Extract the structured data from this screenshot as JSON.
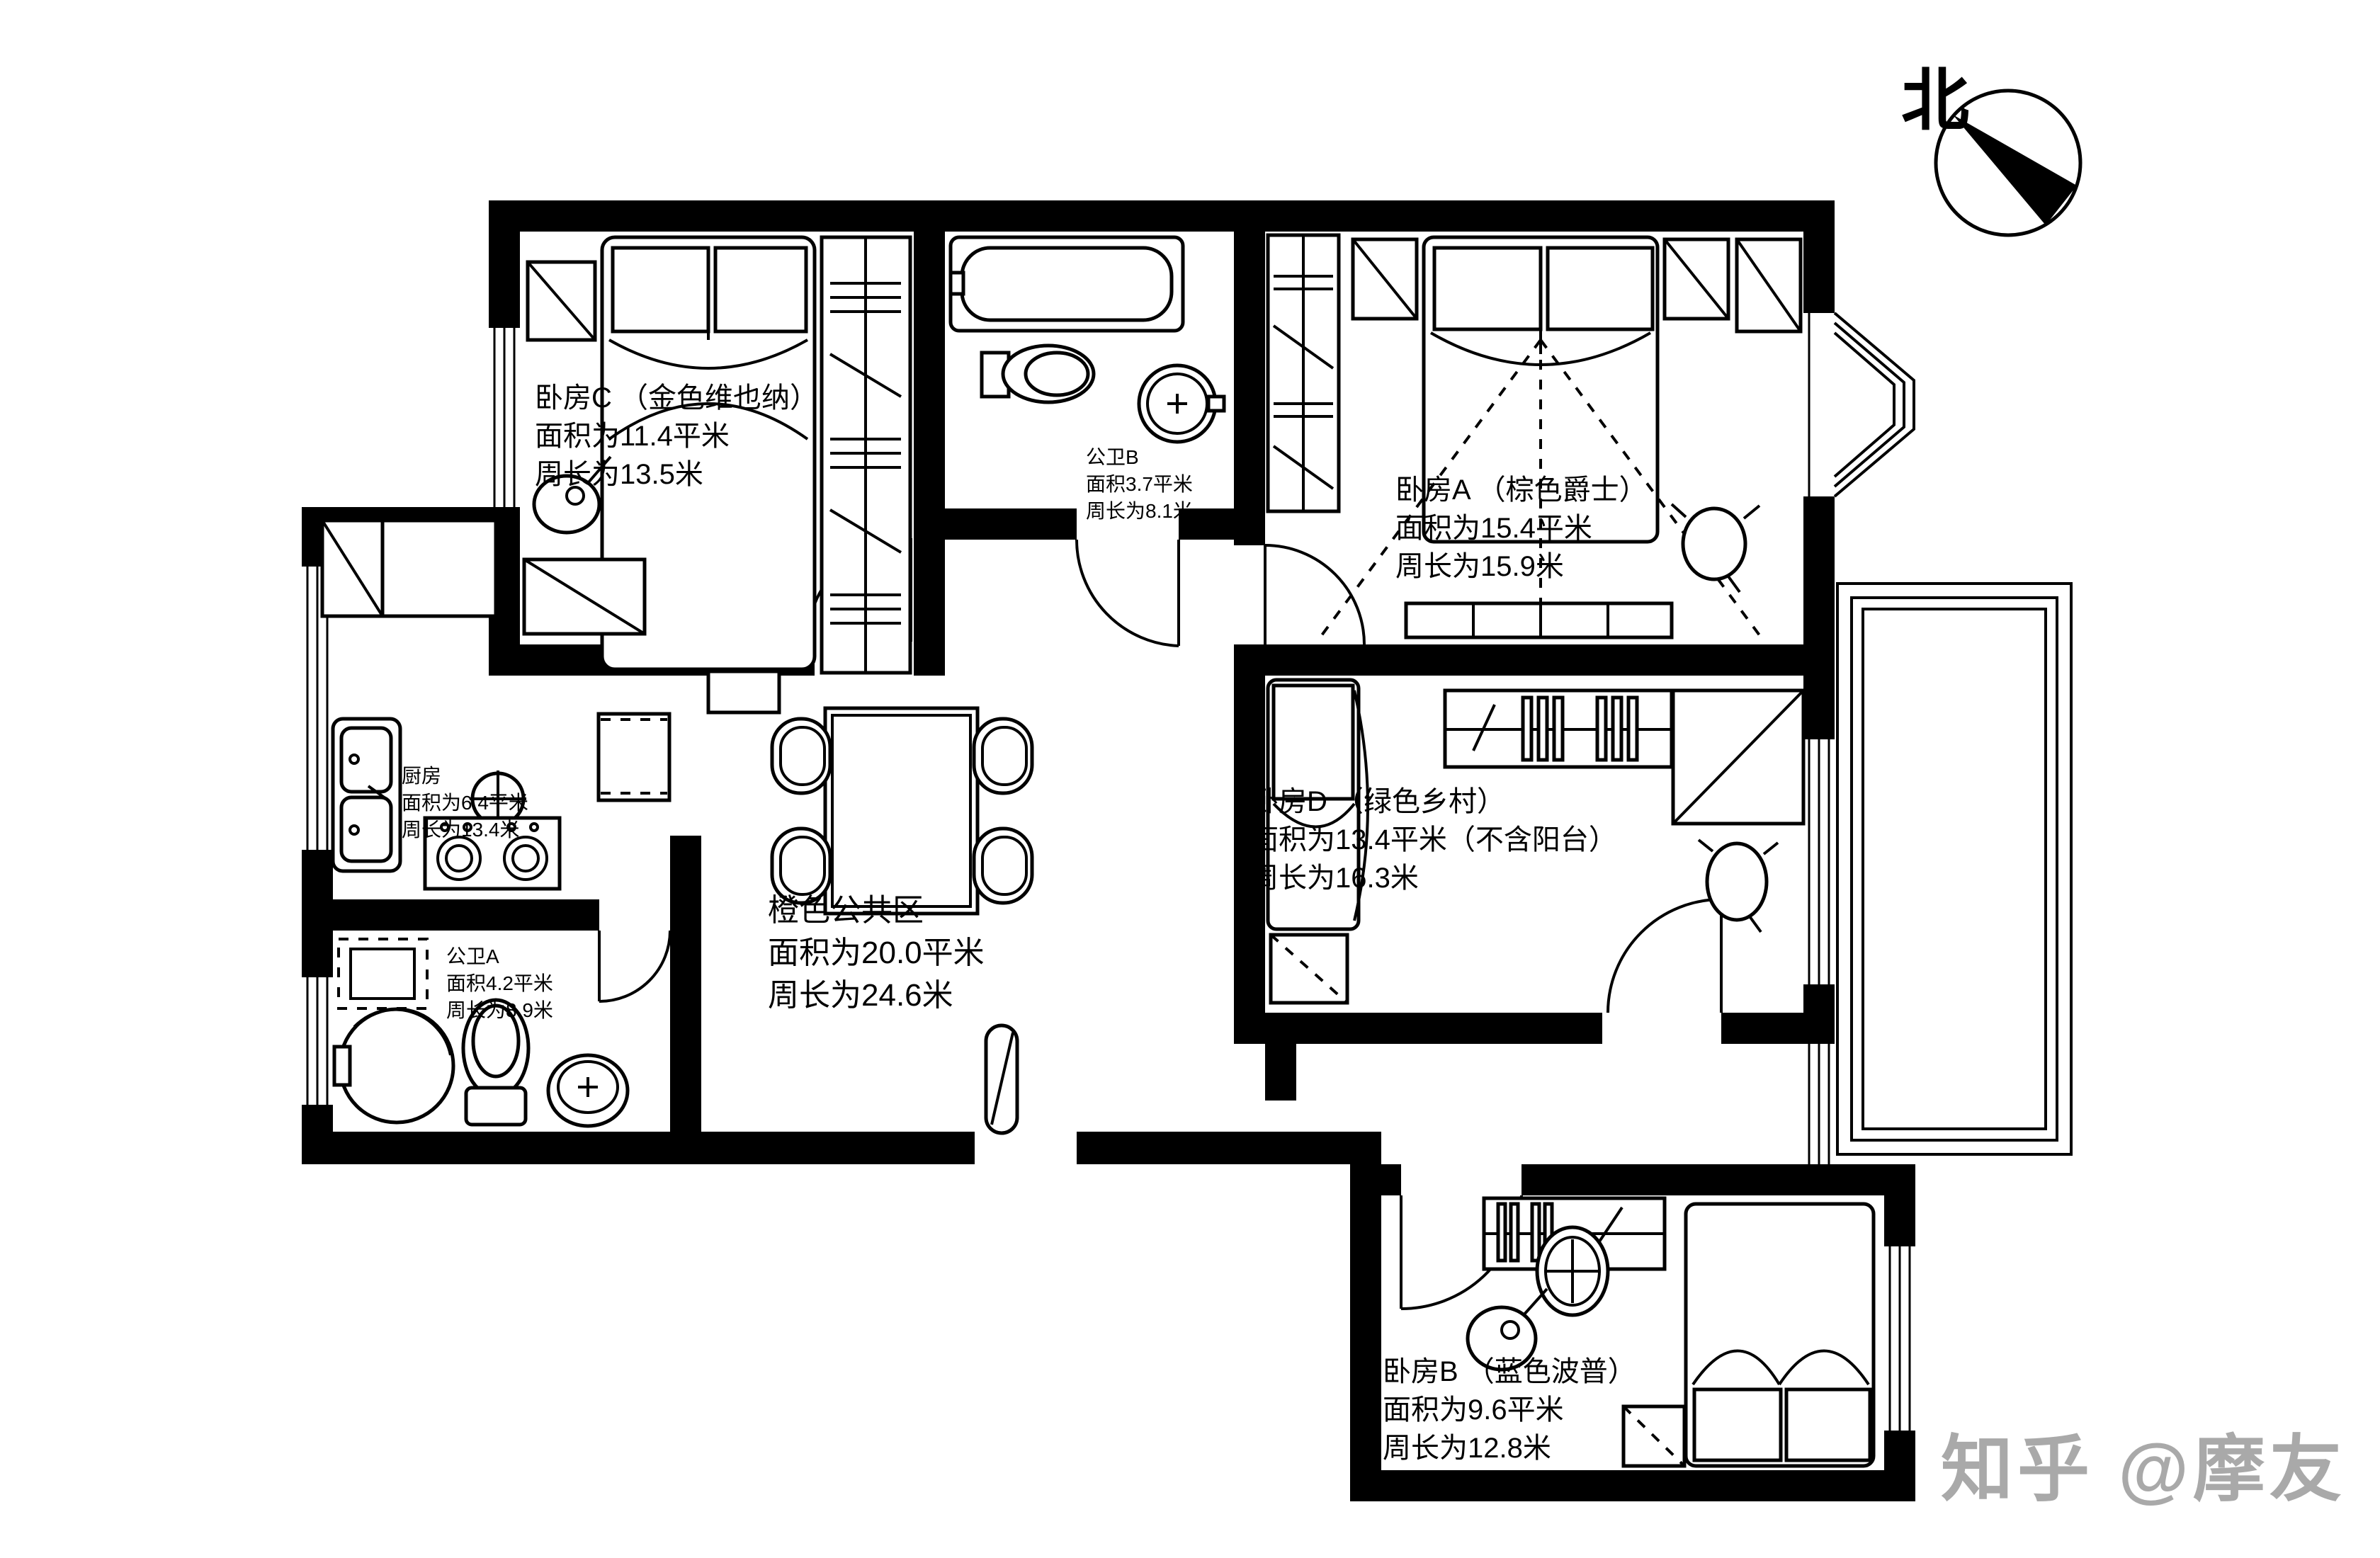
{
  "plan": {
    "line_color": "#000000",
    "background": "#ffffff",
    "watermark_color": "#a9a9a9"
  },
  "compass": {
    "label": "北"
  },
  "watermark": {
    "text": "知乎 @摩友"
  },
  "rooms": {
    "bedroom_c": {
      "name": "卧房C （金色维也纳）",
      "area": "面积为11.4平米",
      "perimeter": "周长为13.5米"
    },
    "bath_b": {
      "name": "公卫B",
      "area": "面积3.7平米",
      "perimeter": "周长为8.1米"
    },
    "bedroom_a": {
      "name": "卧房A （棕色爵士）",
      "area": "面积为15.4平米",
      "perimeter": "周长为15.9米"
    },
    "kitchen": {
      "name": "厨房",
      "area": "面积为6.4平米",
      "perimeter": "周长为13.4米"
    },
    "bath_a": {
      "name": "公卫A",
      "area": "面积4.2平米",
      "perimeter": "周长为8.9米"
    },
    "common": {
      "name": "橙色公共区",
      "area": "面积为20.0平米",
      "perimeter": "周长为24.6米"
    },
    "bedroom_d": {
      "name": "卧房D （绿色乡村）",
      "area": "面积为13.4平米（不含阳台）",
      "perimeter": "周长为16.3米"
    },
    "bedroom_b": {
      "name": "卧房B （蓝色波普）",
      "area": "面积为9.6平米",
      "perimeter": "周长为12.8米"
    }
  }
}
